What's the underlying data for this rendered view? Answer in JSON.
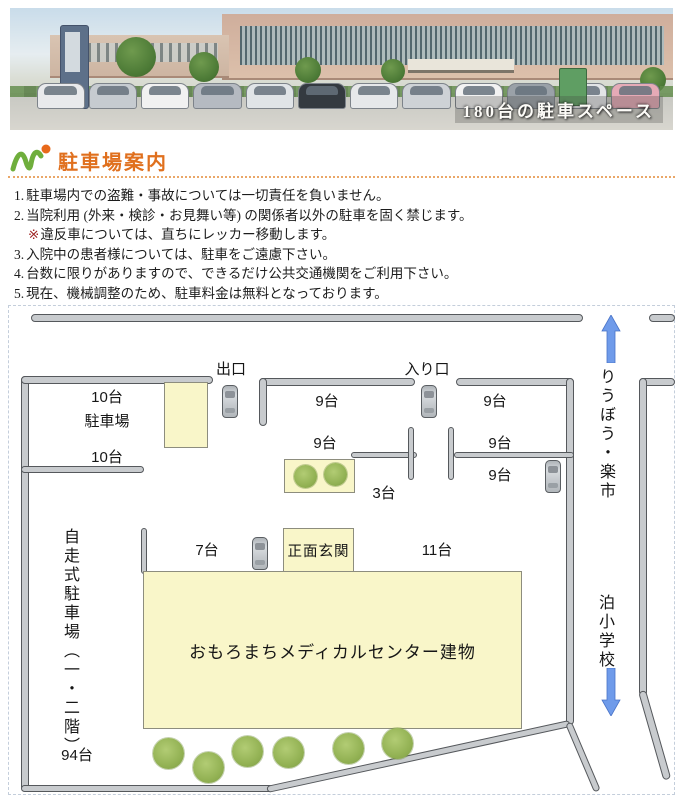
{
  "banner": {
    "caption": "180台の駐車スペース"
  },
  "header": {
    "title": "駐車場案内"
  },
  "notices": {
    "item1": {
      "num": "1.",
      "text": "駐車場内での盗難・事故については一切責任を負いません。"
    },
    "item2": {
      "num": "2.",
      "text": "当院利用 (外来・検診・お見舞い等) の関係者以外の駐車を固く禁じます。"
    },
    "item2_sub": {
      "marker": "※",
      "text": "違反車については、直ちにレッカー移動します。"
    },
    "item3": {
      "num": "3.",
      "text": "入院中の患者様については、駐車をご遠慮下さい。"
    },
    "item4": {
      "num": "4.",
      "text": "台数に限りがありますので、できるだけ公共交通機関をご利用下さい。"
    },
    "item5": {
      "num": "5.",
      "text": "現在、機械調整のため、駐車料金は無料となっております。"
    }
  },
  "map": {
    "exit_label": "出口",
    "entrance_label": "入り口",
    "north_destination": "りうぼう・楽市",
    "south_destination": "泊小学校",
    "nw_lot": {
      "count_top": "10台",
      "label": "駐車場",
      "count_bottom": "10台"
    },
    "row_top": {
      "left": "9台",
      "right": "9台"
    },
    "row_mid": {
      "left": "9台",
      "right_top": "9台",
      "right_bottom": "9台"
    },
    "front": {
      "small": "3台",
      "left": "7台",
      "entrance_label": "正面玄関",
      "right": "11台"
    },
    "building_label": "おもろまちメディカルセンター建物",
    "self_parking": {
      "label": "自走式駐車場（一・二階）",
      "count": "94台"
    }
  },
  "colors": {
    "accent_orange": "#e0701e",
    "logo_green": "#6fae3c",
    "map_yellow": "#f9f6c9",
    "road_gray": "#c8cbce",
    "tree_green": "#93b254",
    "arrow_blue": "#6f9bea",
    "note_marker_red": "#9e2222"
  }
}
